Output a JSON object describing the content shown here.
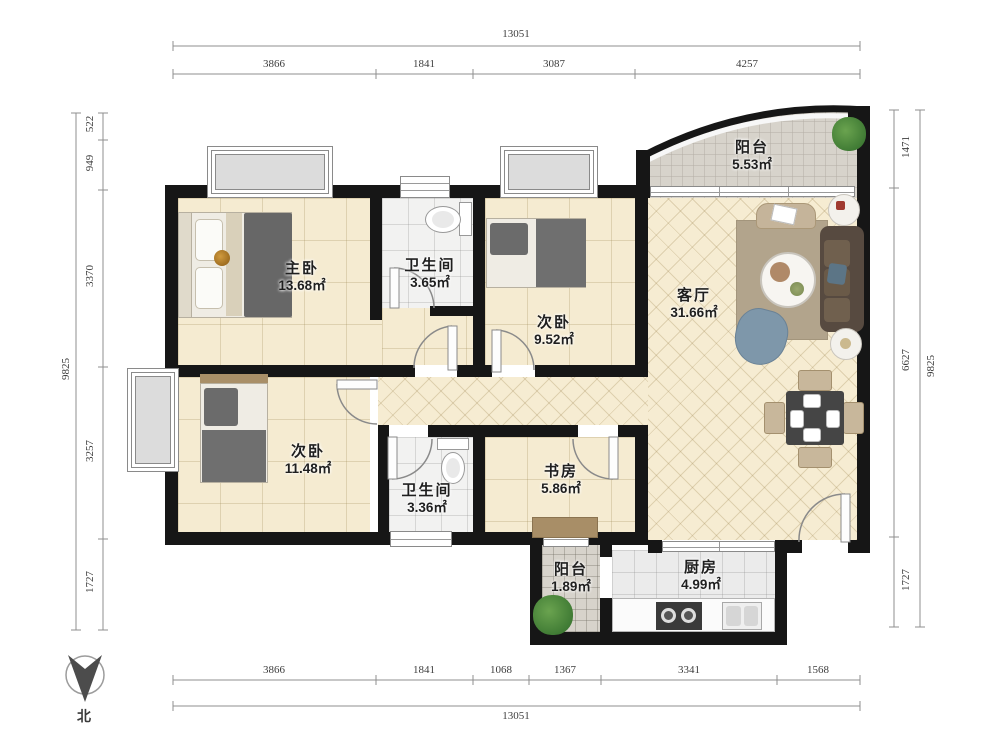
{
  "plan": {
    "rooms": {
      "master_bedroom": {
        "name": "主卧",
        "area": "13.68㎡"
      },
      "bathroom_top": {
        "name": "卫生间",
        "area": "3.65㎡"
      },
      "bedroom_top": {
        "name": "次卧",
        "area": "9.52㎡"
      },
      "living_room": {
        "name": "客厅",
        "area": "31.66㎡"
      },
      "balcony_top": {
        "name": "阳台",
        "area": "5.53㎡"
      },
      "bedroom_bottom": {
        "name": "次卧",
        "area": "11.48㎡"
      },
      "bathroom_bottom": {
        "name": "卫生间",
        "area": "3.36㎡"
      },
      "study": {
        "name": "书房",
        "area": "5.86㎡"
      },
      "balcony_bottom": {
        "name": "阳台",
        "area": "1.89㎡"
      },
      "kitchen": {
        "name": "厨房",
        "area": "4.99㎡"
      }
    },
    "dimensions": {
      "top": {
        "total": "13051",
        "segments": [
          "3866",
          "1841",
          "3087",
          "4257"
        ]
      },
      "bottom": {
        "total": "13051",
        "segments": [
          "3866",
          "1841",
          "1068",
          "1367",
          "3341",
          "1568"
        ]
      },
      "left": {
        "total": "9825",
        "segments": [
          "522",
          "949",
          "3370",
          "3257",
          "1727"
        ]
      },
      "right": {
        "total": "9825",
        "segments": [
          "1471",
          "6627",
          "1727"
        ]
      }
    },
    "compass": {
      "label": "北"
    },
    "colors": {
      "wall": "#161616",
      "floor": "#f5ebd1",
      "balcony_tile": "#d7d3cb",
      "kitchen_tile": "#ebebeb",
      "sofa": "#574a40",
      "armchair": "#7e97aa",
      "rug": "#b2a48c"
    }
  }
}
